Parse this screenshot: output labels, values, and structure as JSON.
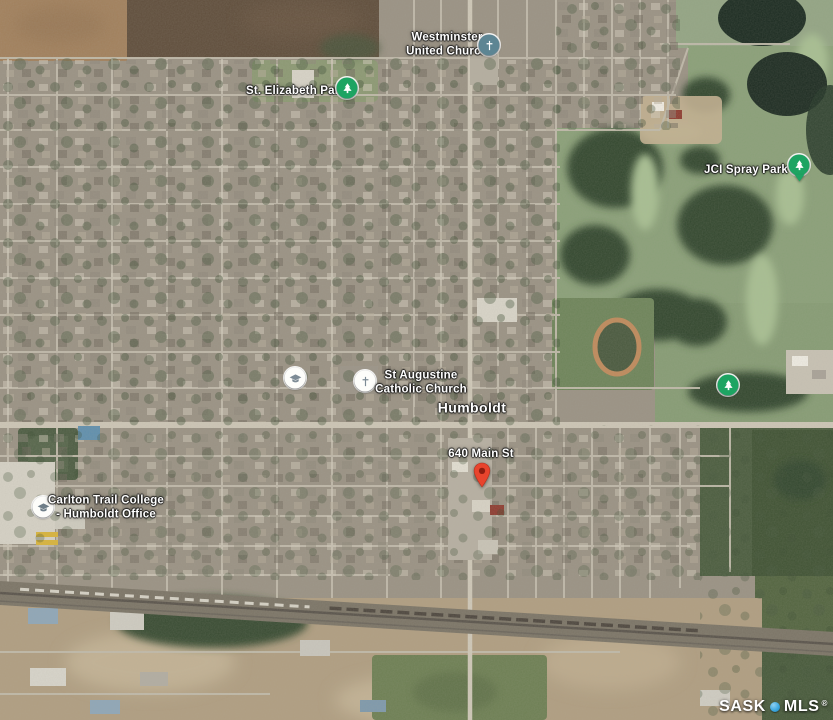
{
  "map_labels": {
    "westminster_united_church": {
      "line1": "Westminster",
      "line2": "United Church"
    },
    "st_elizabeth_park": {
      "label": "St. Elizabeth Park"
    },
    "jci_spray_park": {
      "label": "JCI Spray Park"
    },
    "st_augustine_catholic_church": {
      "line1": "St Augustine",
      "line2": "Catholic Church"
    },
    "humboldt": {
      "label": "Humboldt"
    },
    "address_640_main_st": {
      "label": "640 Main St"
    },
    "carlton_trail_college": {
      "line1": "Carlton Trail College",
      "line2": "- Humboldt Office"
    }
  },
  "watermark": {
    "prefix": "SASK",
    "suffix": "MLS",
    "registered": "®"
  },
  "icons": {
    "park": "tree-in-green-circle",
    "park_pin": "tree-in-green-pin",
    "church_teal": "cross-in-teal-circle",
    "church_white": "cross-in-white-circle",
    "school": "graduation-cap-in-white-circle",
    "marker": "red-map-pin",
    "watermark_logo": "blue-dot"
  },
  "theme": {
    "label_color": "#ffffff",
    "park_icon_green": "#1da462",
    "church_icon_teal": "#5d8593",
    "poi_icon_white": "#fdfdfa",
    "poi_glyph_gray": "#7d8b95",
    "marker_red": "#e8442d",
    "marker_red_dark": "#8e1d10",
    "watermark_blue": "#3fa9e0"
  }
}
